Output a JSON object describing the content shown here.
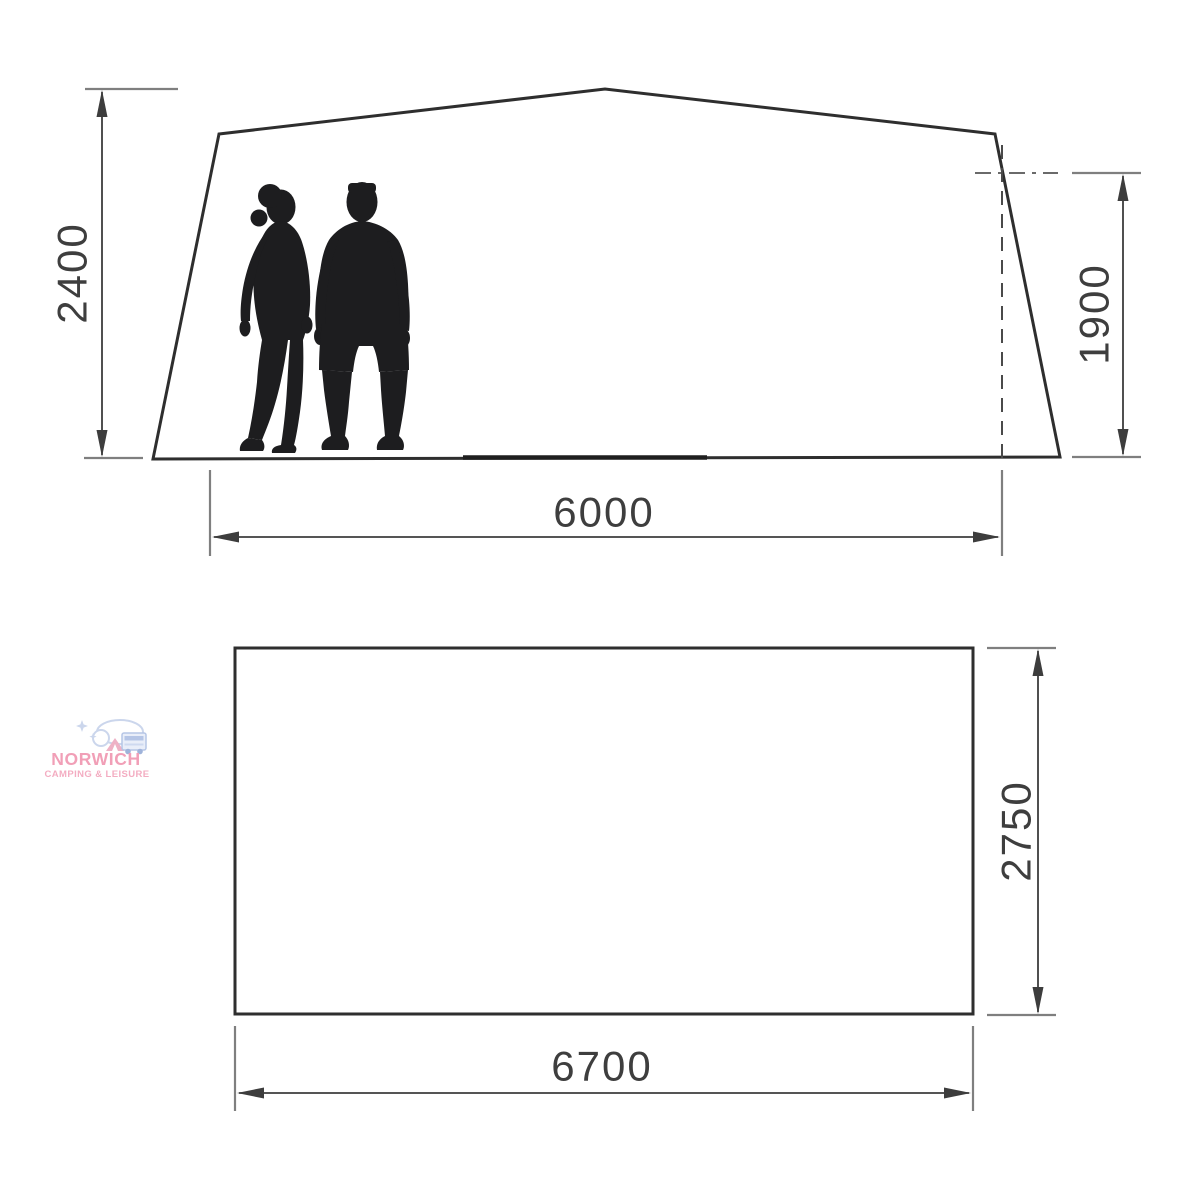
{
  "diagram": {
    "title": "Tent dimension drawing",
    "elevation": {
      "height_label": "2400",
      "rear_height_label": "1900",
      "width_label": "6000"
    },
    "plan": {
      "depth_label": "2750",
      "width_label": "6700"
    }
  },
  "watermark": {
    "name": "NORWICH",
    "tagline": "CAMPING & LEISURE"
  },
  "colors": {
    "background": "#ffffff",
    "outline": "#2e2e2e",
    "dimension_line": "#3d3d3d",
    "extension_line": "#7f7f7f",
    "label_text": "#3e3e3e",
    "silhouette": "#1d1d1f",
    "logo_pink": "#ef8fab",
    "logo_blue": "#c3cfe9"
  }
}
